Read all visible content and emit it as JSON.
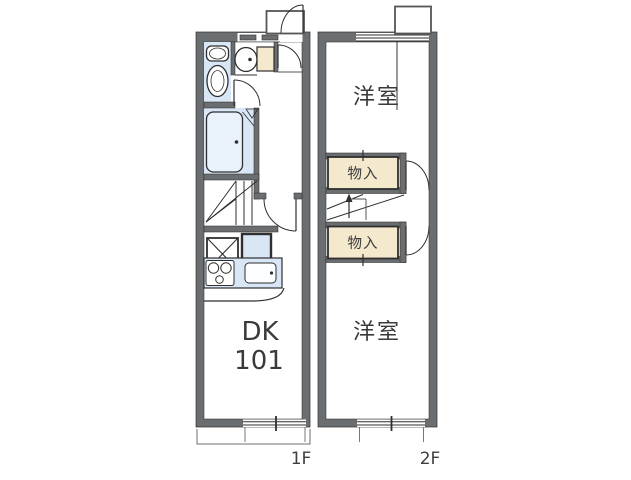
{
  "palette": {
    "wall-gray": "#6b6e71",
    "line": "#2f2f2f",
    "fixture-blue": "#d9e6f6",
    "tub-blue": "#e9f1fb",
    "closet-beige": "#f4e8cd",
    "text": "#3a3a3a",
    "dim": "#6f6f6f"
  },
  "labels": {
    "room_dk": "DK",
    "room_number": "101",
    "room_top_right": "洋室",
    "room_bottom_right": "洋室",
    "closet_top": "物入",
    "closet_bottom": "物入",
    "floor_left": "1F",
    "floor_right": "2F"
  },
  "fixtures": [
    "toilet",
    "washbasin",
    "shoe-cabinet",
    "bathtub",
    "staircase-1f",
    "staircase-2f",
    "washing-machine-space",
    "refrigerator-space",
    "kitchen-counter",
    "gas-stove",
    "kitchen-sink",
    "entrance-door",
    "washroom-door",
    "hallway-door",
    "dk-door",
    "room-door-top",
    "room-door-bottom",
    "storage-closet-top",
    "storage-closet-bottom",
    "window",
    "dimension-bracket",
    "entrance-porch",
    "bay-projection"
  ]
}
